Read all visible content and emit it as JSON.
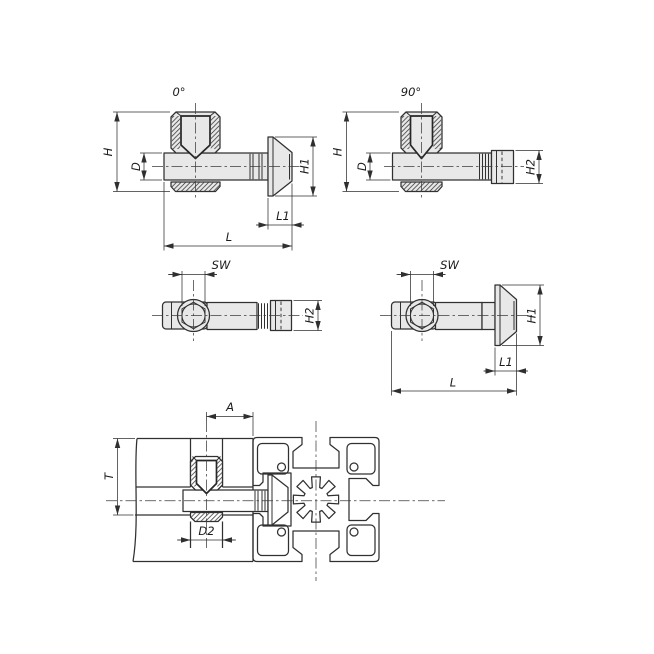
{
  "drawing": {
    "type": "technical-drawing",
    "subject": "t-slot-fastener",
    "colors": {
      "background": "#ffffff",
      "line": "#303030",
      "part_fill": "#e8e8e8"
    },
    "views": {
      "side0": {
        "angle": "0°",
        "h": "H",
        "d": "D",
        "h1": "H1",
        "l1": "L1",
        "l": "L"
      },
      "side90": {
        "angle": "90°",
        "h": "H",
        "d": "D",
        "h2": "H2"
      },
      "top0": {
        "sw": "SW",
        "h2": "H2"
      },
      "top90": {
        "sw": "SW",
        "h1": "H1",
        "l1": "L1",
        "l": "L"
      },
      "assembly": {
        "a": "A",
        "t": "T",
        "d2": "D2"
      }
    }
  }
}
